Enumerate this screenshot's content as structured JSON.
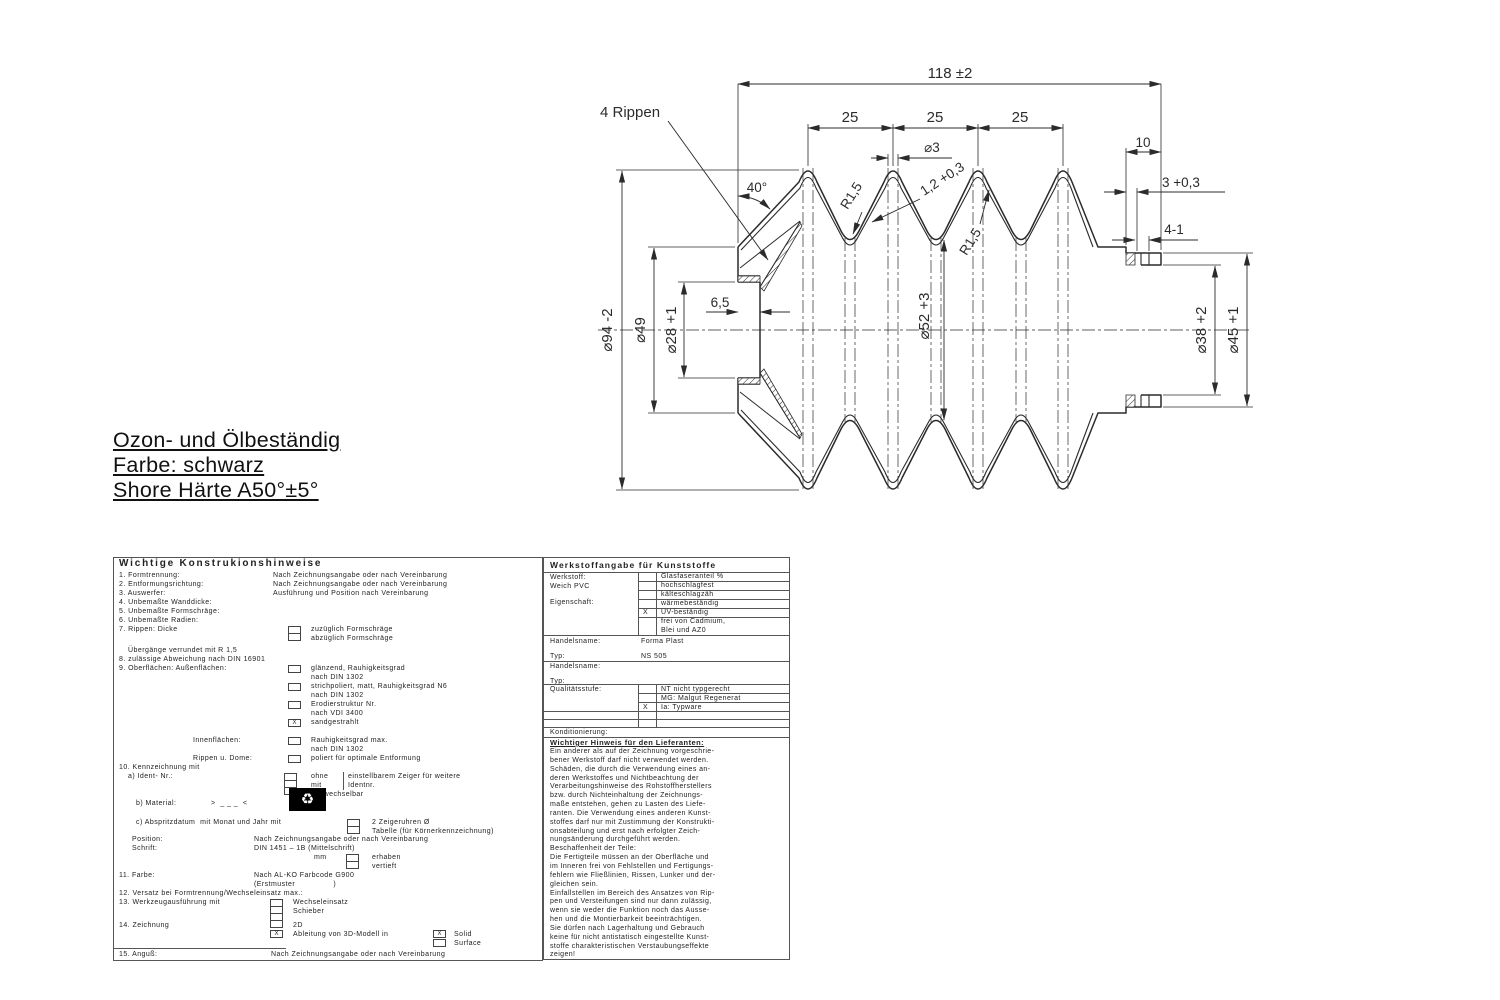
{
  "marks": {
    "x": "X",
    "recycle": "♻"
  },
  "notes": {
    "line1": "Ozon- und Ölbeständig",
    "line2": "Farbe: schwarz",
    "line3": "Shore Härte A50°±5°"
  },
  "drawing": {
    "dims": {
      "rippen": "4 Rippen",
      "overall": "118 ±2",
      "pitch_1": "25",
      "pitch_2": "25",
      "pitch_3": "25",
      "tip_dia": "⌀3",
      "wall": "1,2 +0,3",
      "angle": "40°",
      "radius_1": "R1,5",
      "radius_2": "R1,5",
      "sleeve_len": "10",
      "sleeve_wall": "3 +0,3",
      "step": "4-1",
      "d94": "⌀94 -2",
      "d49": "⌀49",
      "d28": "⌀28 +1",
      "collar_w": "6,5",
      "d52": "⌀52 +3",
      "d38": "⌀38 +2",
      "d45": "⌀45 +1"
    }
  },
  "left_table": {
    "header": "Wichtige Konstrukionshinweise",
    "r1_l": "1. Formtrennung:",
    "r1_v": "Nach Zeichnungsangabe oder nach Vereinbarung",
    "r2_l": "2. Entformungsrichtung:",
    "r2_v": "Nach Zeichnungsangabe oder nach Vereinbarung",
    "r3_l": "3. Auswerfer:",
    "r3_v": "Ausführung und Position nach Vereinbarung",
    "r4": "4. Unbemaßte Wanddicke:",
    "r5": "5. Unbemaßte Formschräge:",
    "r6": "6. Unbemaßte Radien:",
    "r7_l": "7. Rippen: Dicke",
    "r7_a": "zuzüglich Formschräge",
    "r7_b": "abzüglich Formschräge",
    "r7_c": "Übergänge verrundet mit R 1,5",
    "r8": "8. zulässige Abweichung nach DIN 16901",
    "r9_l": "9. Oberflächen: Außenflächen:",
    "r9_a1": "glänzend, Rauhigkeitsgrad",
    "r9_a2": "nach DIN 1302",
    "r9_b1": "strichpoliert, matt, Rauhigkeitsgrad N6",
    "r9_b2": "nach DIN 1302",
    "r9_c1": "Erodierstruktur Nr.",
    "r9_c2": "nach VDI 3400",
    "r9_d": "sandgestrahlt",
    "r9_innen_l": "Innenflächen:",
    "r9_innen_1": "Rauhigkeitsgrad max.",
    "r9_innen_2": "nach DIN 1302",
    "r9_rippen_l": "Rippen u. Dome:",
    "r9_rippen_1": "poliert für optimale Entformung",
    "r10": "10. Kennzeichnung mit",
    "r10a_l": "a) Ident- Nr.:",
    "r10a_1": "ohne",
    "r10a_2": "mit",
    "r10a_3": "auswechselbar",
    "r10a_r1": "einstellbarem Zeiger für weitere",
    "r10a_r2": "Identnr.",
    "r10b_l": "b) Material:",
    "r10b_v": ">  _ _ _  <",
    "r10c_l": "c) Abspritzdatum  mit Monat und Jahr mit",
    "r10c_1": "2 Zeigeruhren Ø",
    "r10c_2": "Tabelle (für Körnerkennzeichnung)",
    "pos_l": "Position:",
    "pos_v": "Nach Zeichnungsangabe oder nach Vereinbarung",
    "schrift_l": "Schrift:",
    "schrift_v": "DIN 1451 – 1B (Mittelschrift)",
    "mm_l": "mm",
    "mm_1": "erhaben",
    "mm_2": "vertieft",
    "r11_l": "11. Farbe:",
    "r11_v": "Nach AL-KO Farbcode G900",
    "r11_v2": "(Erstmuster                )",
    "r12": "12. Versatz bei Formtrennung/Wechseleinsatz max.:",
    "r13_l": "13. Werkzeugausführung mit",
    "r13_a": "Wechseleinsatz",
    "r13_b": "Schieber",
    "r14_l": "14. Zeichnung",
    "r14_a": "2D",
    "r14_b": "Ableitung von 3D-Modell in",
    "r14_c": "Solid",
    "r14_d": "Surface",
    "r15_l": "15. Anguß:",
    "r15_v": "Nach Zeichnungsangabe oder nach Vereinbarung"
  },
  "right_table": {
    "header": "Werkstoffangabe für Kunststoffe",
    "werkstoff_l": "Werkstoff:",
    "werkstoff_v": "Weich PVC",
    "eigenschaft_l": "Eigenschaft:",
    "prop_1": "Glasfaseranteil %",
    "prop_2": "hochschlagfest",
    "prop_3": "kälteschlagzäh",
    "prop_4": "wärmebeständig",
    "prop_5": "UV-beständig",
    "prop_6a": "frei von Cadmium,",
    "prop_6b": "Blei und AZ0",
    "handelsname1_l": "Handelsname:",
    "handelsname1_v": "Forma Plast",
    "typ1_l": "Typ:",
    "typ1_v": "NS 505",
    "handelsname2_l": "Handelsname:",
    "typ2_l": "Typ:",
    "qual_l": "Qualitätsstufe:",
    "qual_1": "NT nicht typgerecht",
    "qual_2": "MG: Malgut Regenerat",
    "qual_3": "Ia: Typware",
    "kond": "Konditionierung:",
    "hinweis_title": "Wichtiger Hinweis für den Lieferanten:",
    "hinweis_text": "Ein anderer als auf der Zeichnung vorgeschrie-\nbener Werkstoff darf nicht verwendet werden.\nSchäden, die durch die Verwendung eines an-\nderen Werkstoffes und Nichtbeachtung der\nVerarbeitungshinweise des Rohstoffherstellers\nbzw. durch Nichteinhaltung der Zeichnungs-\nmaße entstehen, gehen zu Lasten des Liefe-\nranten. Die Verwendung eines anderen Kunst-\nstoffes darf nur mit Zustimmung der Konstrukti-\nonsabteilung und erst nach erfolgter Zeich-\nnungsänderung durchgeführt werden.\nBeschaffenheit der Teile:\nDie Fertigteile müssen an der Oberfläche und\nim Inneren frei von Fehlstellen und Fertigungs-\nfehlern wie Fließlinien, Rissen, Lunker und der-\ngleichen sein.\nEinfallstellen im Bereich des Ansatzes von Rip-\npen und Versteifungen sind nur dann zulässig,\nwenn sie weder die Funktion noch das Ausse-\nhen und die Montierbarkeit beeinträchtigen.\nSie dürfen nach Lagerhaltung und Gebrauch\nkeine für nicht antistatisch eingestellte Kunst-\nstoffe charakteristischen Verstaubungseffekte\nzeigen!"
  }
}
